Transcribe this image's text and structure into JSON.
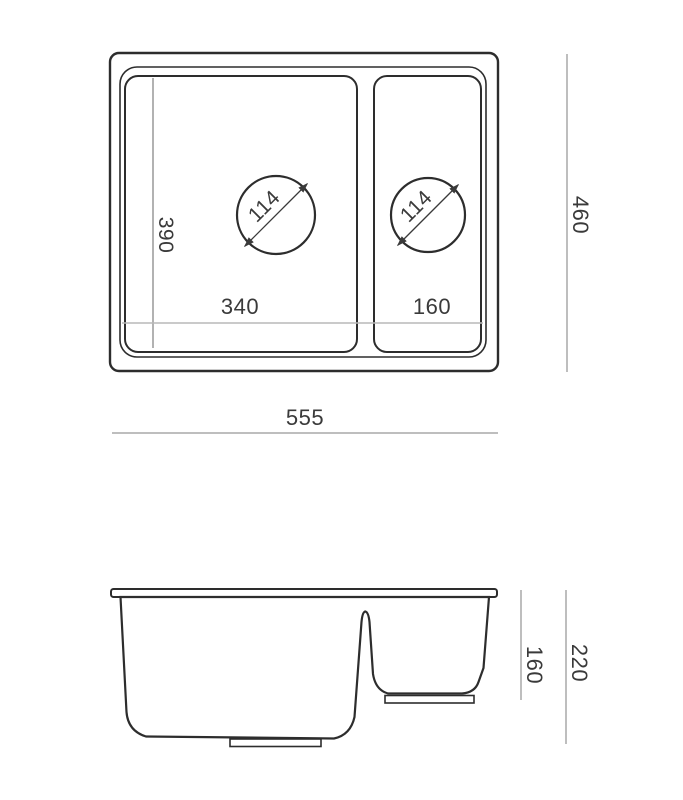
{
  "drawing": {
    "top_view": {
      "overall_width": "555",
      "overall_depth": "460",
      "main_bowl_width": "340",
      "small_bowl_width": "160",
      "bowl_length": "390",
      "main_drain_diameter": "114",
      "small_drain_diameter": "114"
    },
    "side_view": {
      "overall_height": "220",
      "small_bowl_depth": "160"
    },
    "colors": {
      "outline": "#2d2d2d",
      "dim_line": "#a8a8a8",
      "thin_line": "#7e7e7e",
      "light_line": "#b9b9b9",
      "text_color": "#3a3a3a",
      "background": "#ffffff"
    }
  }
}
